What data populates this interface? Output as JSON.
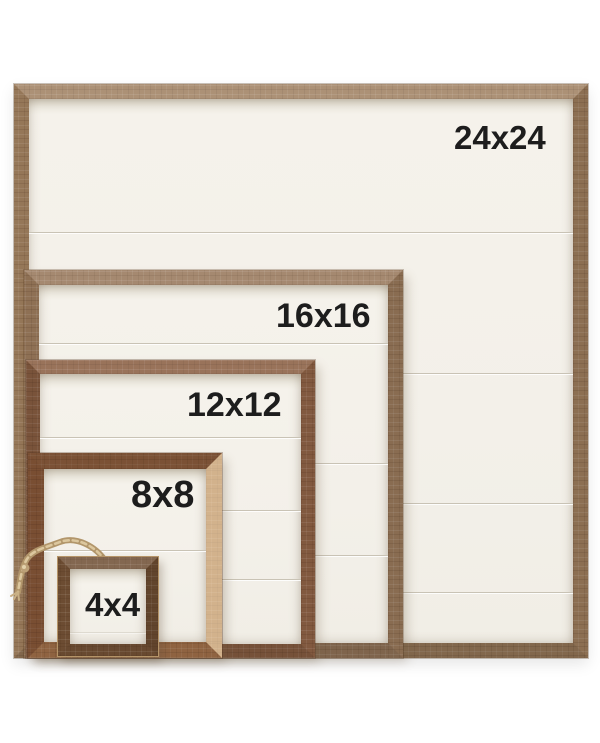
{
  "frames": [
    {
      "name": "frame-24x24",
      "label": "24x24"
    },
    {
      "name": "frame-16x16",
      "label": "16x16"
    },
    {
      "name": "frame-12x12",
      "label": "12x12"
    },
    {
      "name": "frame-8x8",
      "label": "8x8"
    },
    {
      "name": "frame-4x4",
      "label": "4x4"
    }
  ],
  "icons": {
    "twine_hanger": "twine-hanger-icon"
  },
  "colors": {
    "background": "#ffffff",
    "wood_tan": "#9c7c5c",
    "wood_medium_brown": "#8a5f43",
    "wood_red_brown": "#7c4c38",
    "wood_light_raw": "#d2b384",
    "wood_dark_walnut": "#6f4e33",
    "panel_cream": "#f3f0e9",
    "seam_gray": "#c9c3b5",
    "label_black": "#1d1d1d",
    "twine_tan": "#c4a97e"
  }
}
